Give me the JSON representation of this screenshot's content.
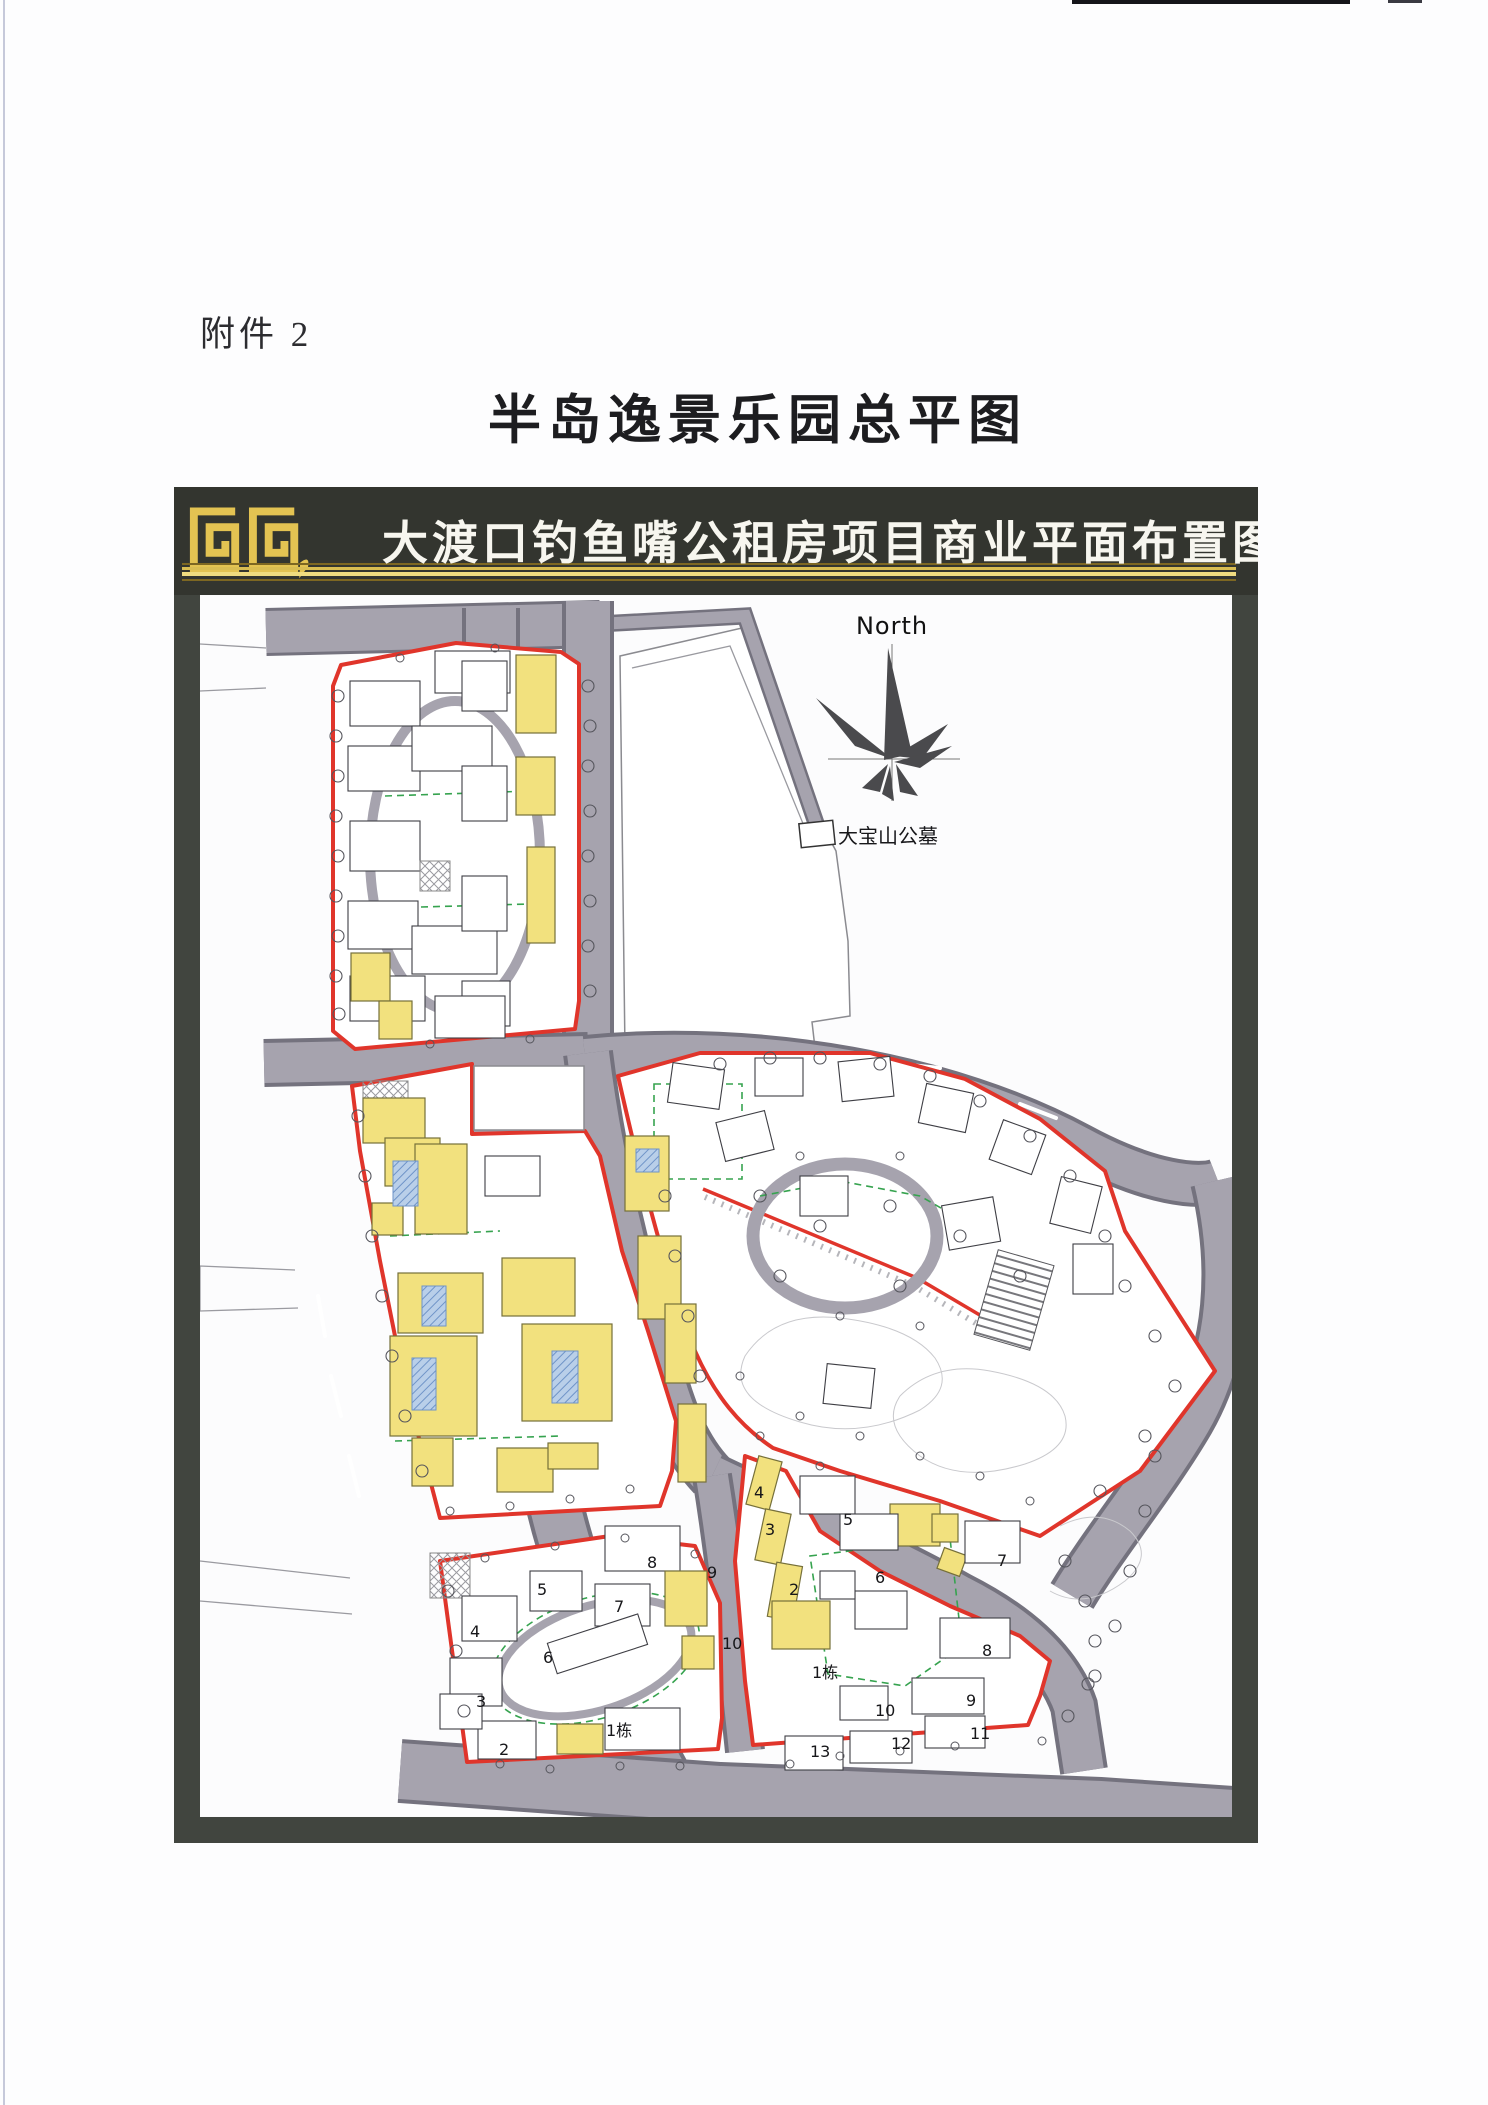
{
  "page": {
    "attachment_label": "附件 2",
    "title": "半岛逸景乐园总平图"
  },
  "banner": {
    "title": "大渡口钓鱼嘴公租房项目商业平面布置图"
  },
  "map": {
    "north_label": "North",
    "cemetery_label": "大宝山公墓",
    "block_d_labels": [
      "8",
      "5",
      "9",
      "7",
      "4",
      "6",
      "3",
      "10",
      "1栋",
      "2"
    ],
    "block_e_labels": [
      "4",
      "3",
      "5",
      "2",
      "6",
      "7",
      "8",
      "1栋",
      "9",
      "10",
      "11",
      "12",
      "13"
    ]
  },
  "theme": {
    "road": "#a6a3ae",
    "road-edge": "#74727e",
    "red": "#e0352b",
    "yellow": "#f2e17e",
    "green": "#36a34f",
    "blue": "#b9cfe9",
    "banner": "#33352f",
    "gold": "#e3c352",
    "frame": "#41453f"
  }
}
